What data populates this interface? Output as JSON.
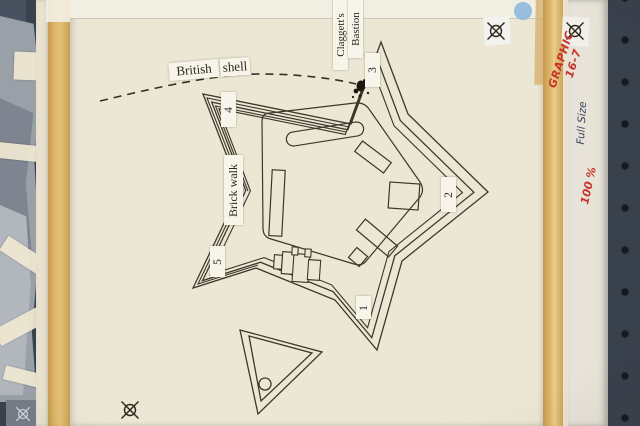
{
  "diagram": {
    "subject": "star fort plan paste-up",
    "labels": {
      "british": "British",
      "shell": "shell",
      "claggetts": "Claggett's",
      "bastion": "Bastion",
      "brick_walk": "Brick walk"
    },
    "bastion_numbers": {
      "b1": "1",
      "b2": "2",
      "b3": "3",
      "b4": "4",
      "b5": "5"
    }
  },
  "margin_notes": {
    "graphic_line1": "GRAPHIC",
    "graphic_line2": "16-7",
    "full_size": "Full Size",
    "scale_percent": "100 %"
  },
  "colors": {
    "paper": "#ece7d5",
    "ink": "#3e362a",
    "tape_yellow": "#ddb66a",
    "red_marker": "#c5332a",
    "blue_ink": "#39435c",
    "pegboard": "#39414d",
    "blue_dot": "#8fb7de"
  }
}
